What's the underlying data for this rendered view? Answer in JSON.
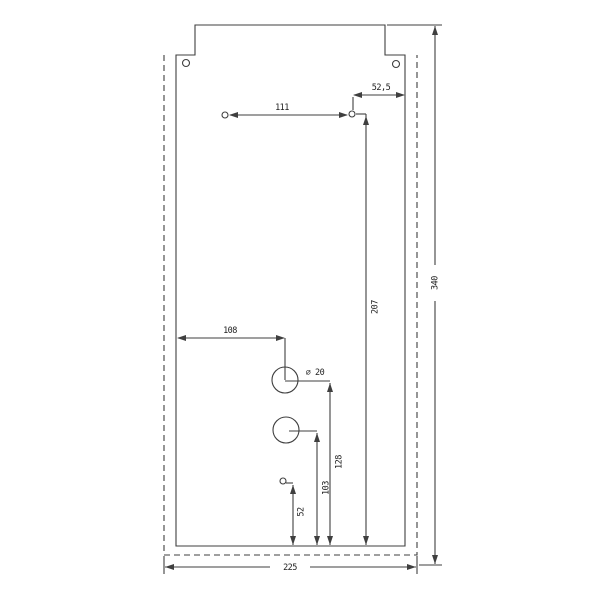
{
  "drawing": {
    "kind": "technical-drawing-plate",
    "dimensions": {
      "hole_spacing_top": "111",
      "offset_right_top": "52,5",
      "overall_height": "340",
      "top_hole_from_bottom": "207",
      "circle_from_left": "108",
      "circle_diameter": "⌀ 20",
      "upper_circle_from_bottom": "128",
      "lower_circle_from_bottom": "103",
      "small_hole_from_bottom": "52",
      "overall_width": "225"
    },
    "colors": {
      "background": "#ffffff",
      "line": "#3f3f3f",
      "text": "#1e1e1e"
    }
  }
}
